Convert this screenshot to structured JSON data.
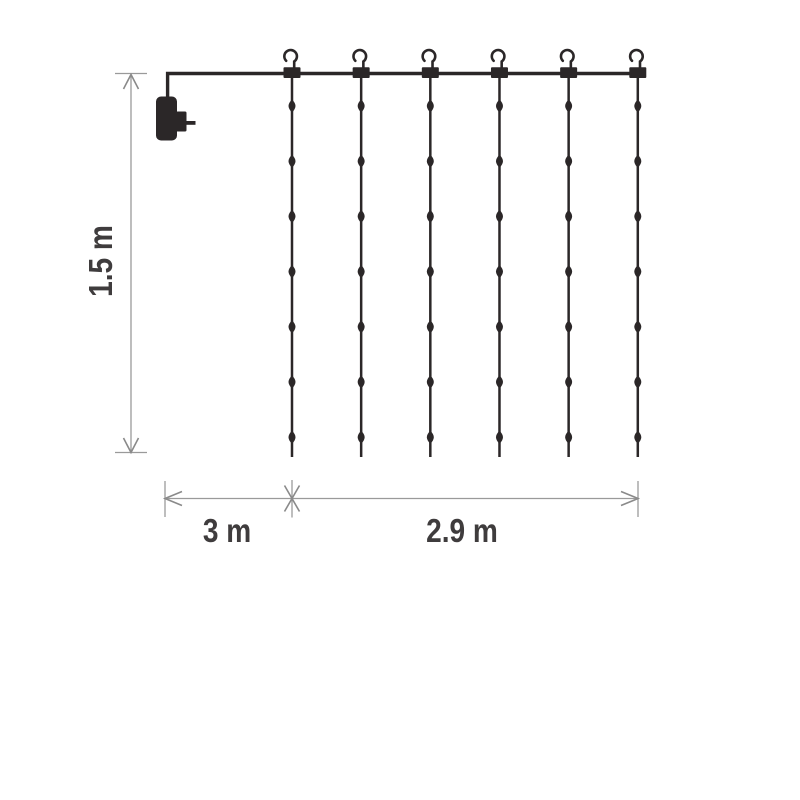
{
  "labels": {
    "height": "1.5 m",
    "lead": "3 m",
    "width": "2.9 m"
  },
  "curtain": {
    "strands": 6,
    "hooks": 6,
    "leds_per_strand": 7,
    "total_leds": 42
  },
  "icons": {
    "hook": "hook-icon",
    "plug": "power-plug-icon",
    "led": "led-light"
  },
  "colors": {
    "line": "#2b2728",
    "dimension": "#9a9a9a",
    "dimension_arrow": "#8a8a8a",
    "text": "#3f3c3d",
    "background": "#ffffff"
  }
}
